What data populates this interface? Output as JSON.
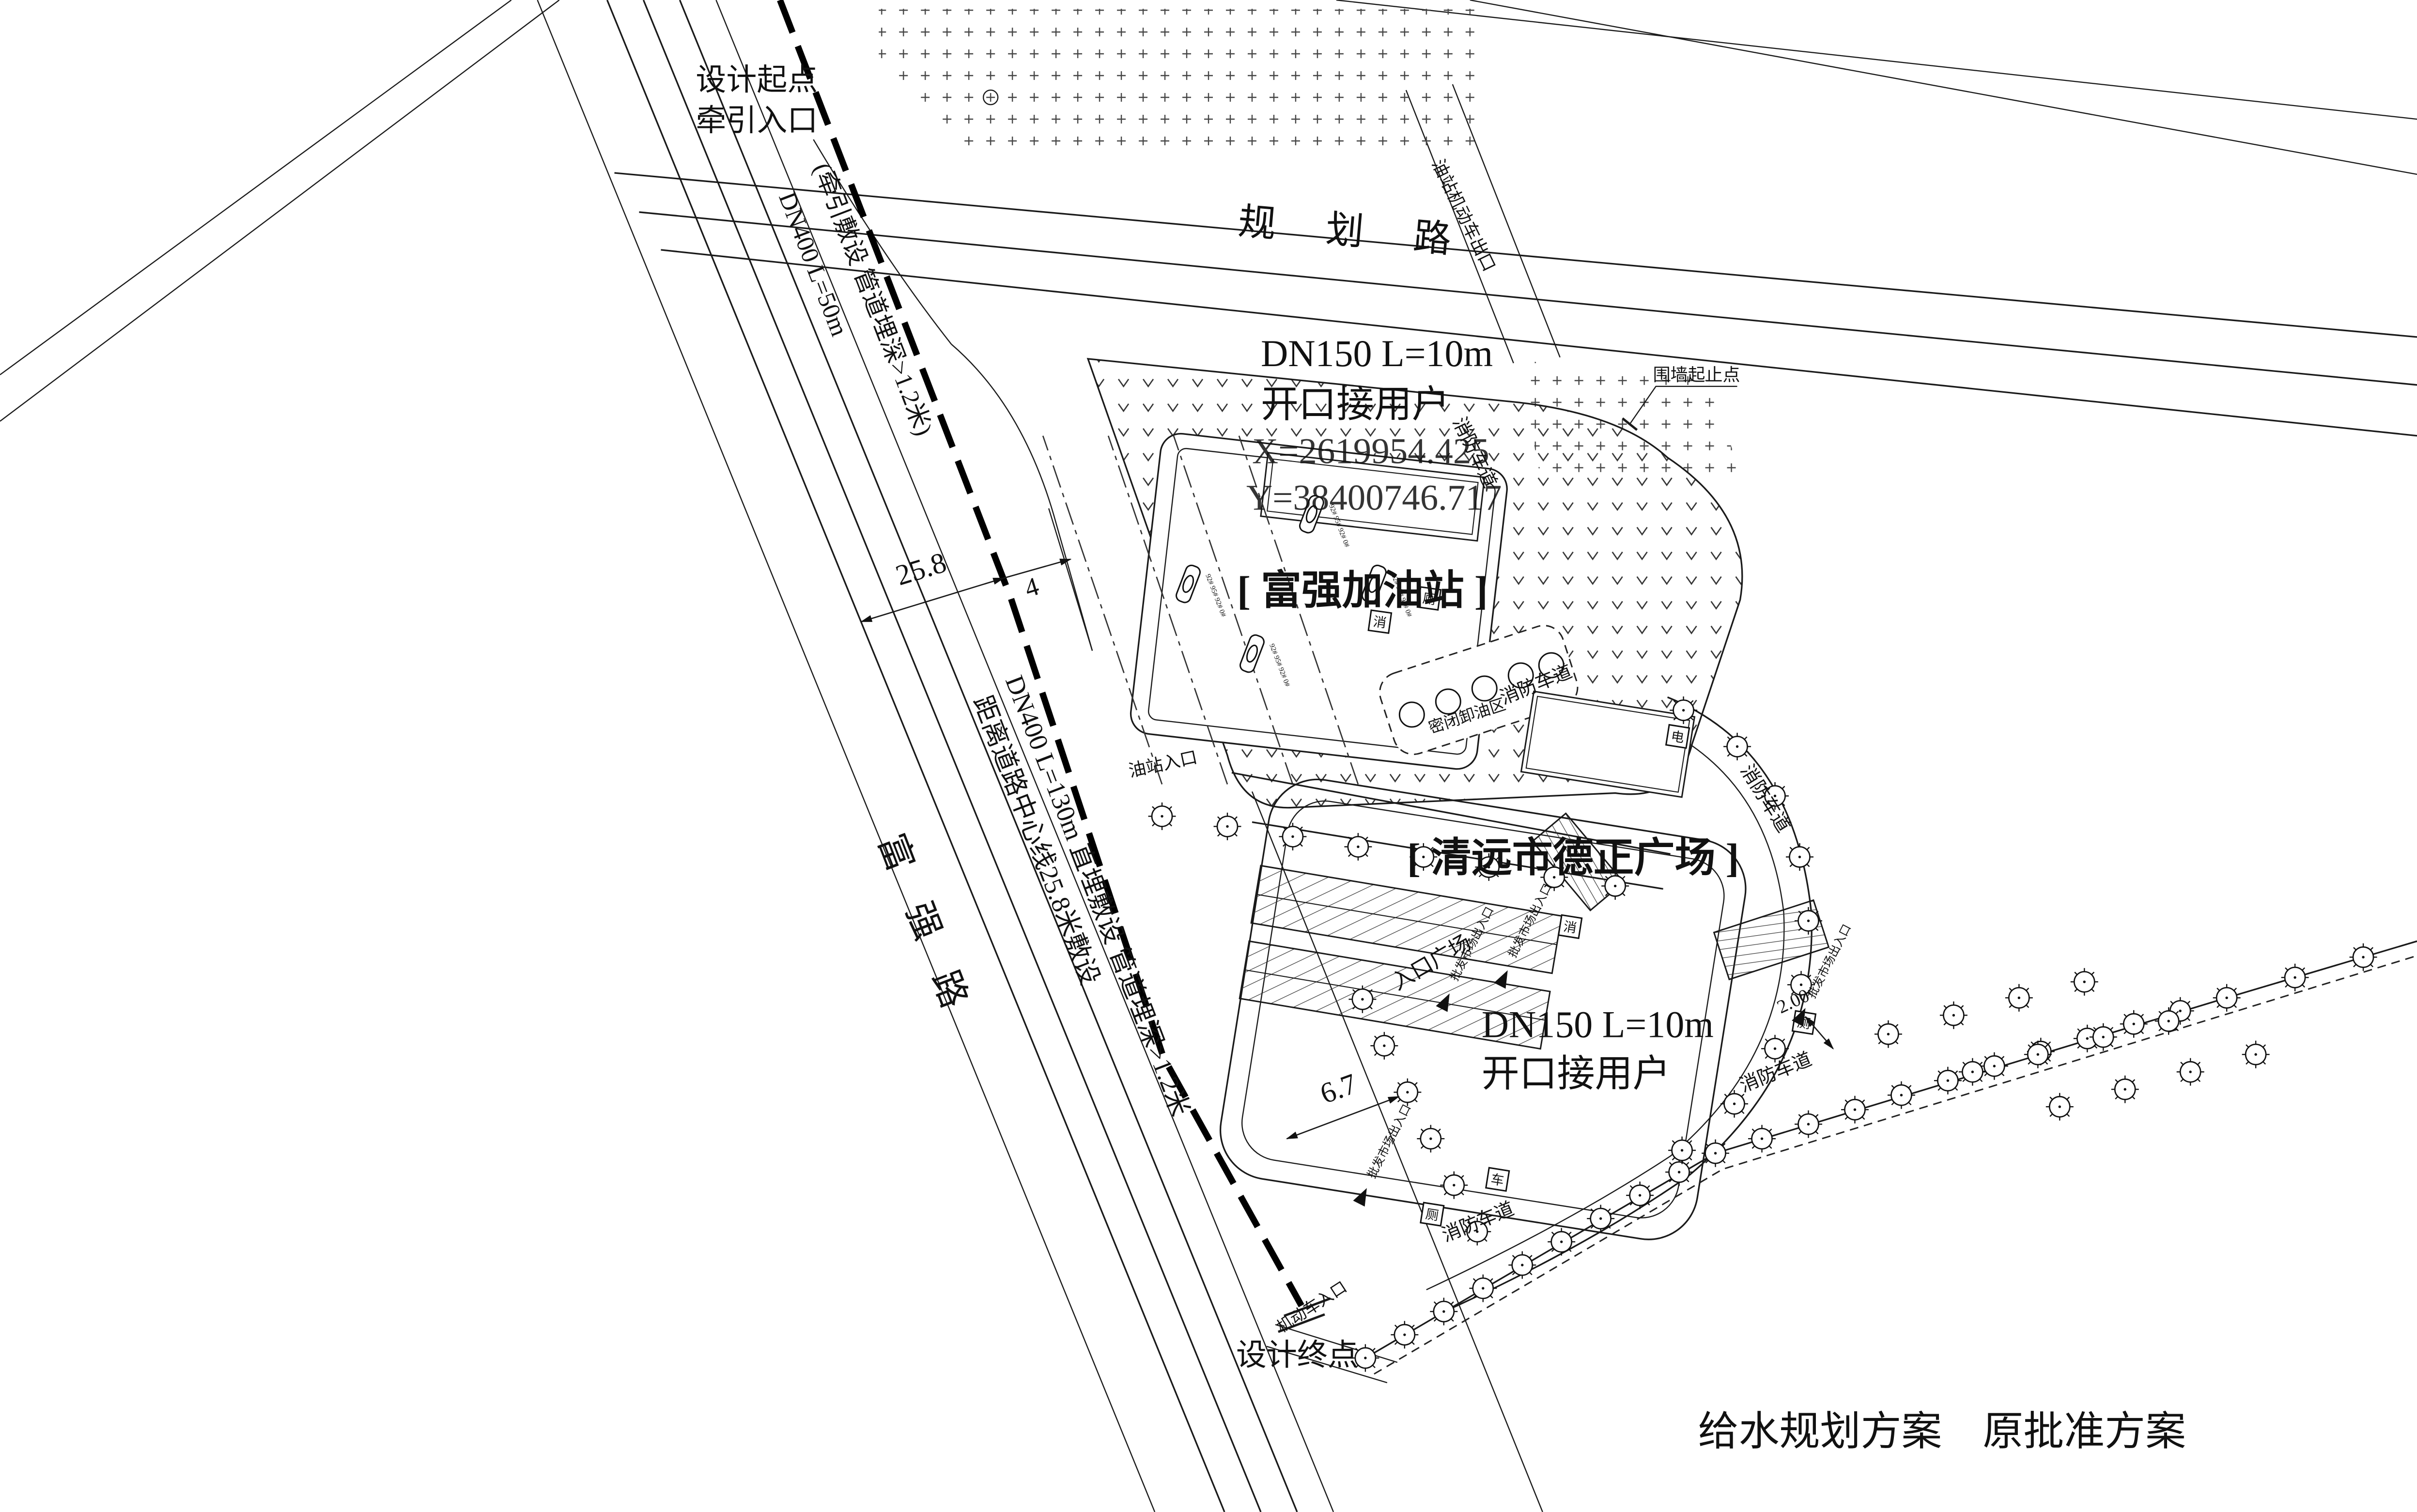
{
  "drawing": {
    "title": "给水规划方案　原批准方案",
    "roads": {
      "planning_road": "规 划 路",
      "fuqiang_road": [
        "富",
        "强",
        "路"
      ]
    },
    "pipeline": {
      "start_point_line1": "设计起点",
      "start_point_line2": "牵引入口",
      "end_point": "设计终点",
      "upper_segment_note": "(牵引敷设 管道埋深>1.2米)",
      "upper_segment_spec": "DN400 L=50m",
      "lower_segment_spec": "DN400 L=130m 直埋敷设 管道埋深>1.2米",
      "lower_segment_note": "距离道路中心线25.8米敷设"
    },
    "service_connections": {
      "north": {
        "spec": "DN150 L=10m",
        "note": "开口接用户",
        "x_coord": "X=2619954.425",
        "y_coord": "Y=38400746.717"
      },
      "south": {
        "spec": "DN150 L=10m",
        "note": "开口接用户"
      }
    },
    "dimensions": {
      "road_center_offset": "25.8",
      "pipe_clearance": "4",
      "plaza_offset": "6.7",
      "setback": "2.00"
    },
    "sites": {
      "gas_station": "[ 富强加油站 ]",
      "plaza": "[ 清远市德正广场 ]"
    },
    "labels": {
      "wall_endpoints": "围墙起止点",
      "station_vehicle_exit": "油站机动车出口",
      "station_entrance": "油站入口",
      "market_gate": "批发市场出入口",
      "entrance_plaza": "入口广场",
      "fire_lane": "消防车道",
      "vehicle_entrance": "机动车入口",
      "sealed_unloading_area": "密闭卸油区",
      "dispenser_grades": "92# 95# 92# 0#"
    },
    "symbols": {
      "fire": "消",
      "toilet": "厕",
      "vehicle": "车",
      "electric": "电"
    }
  }
}
